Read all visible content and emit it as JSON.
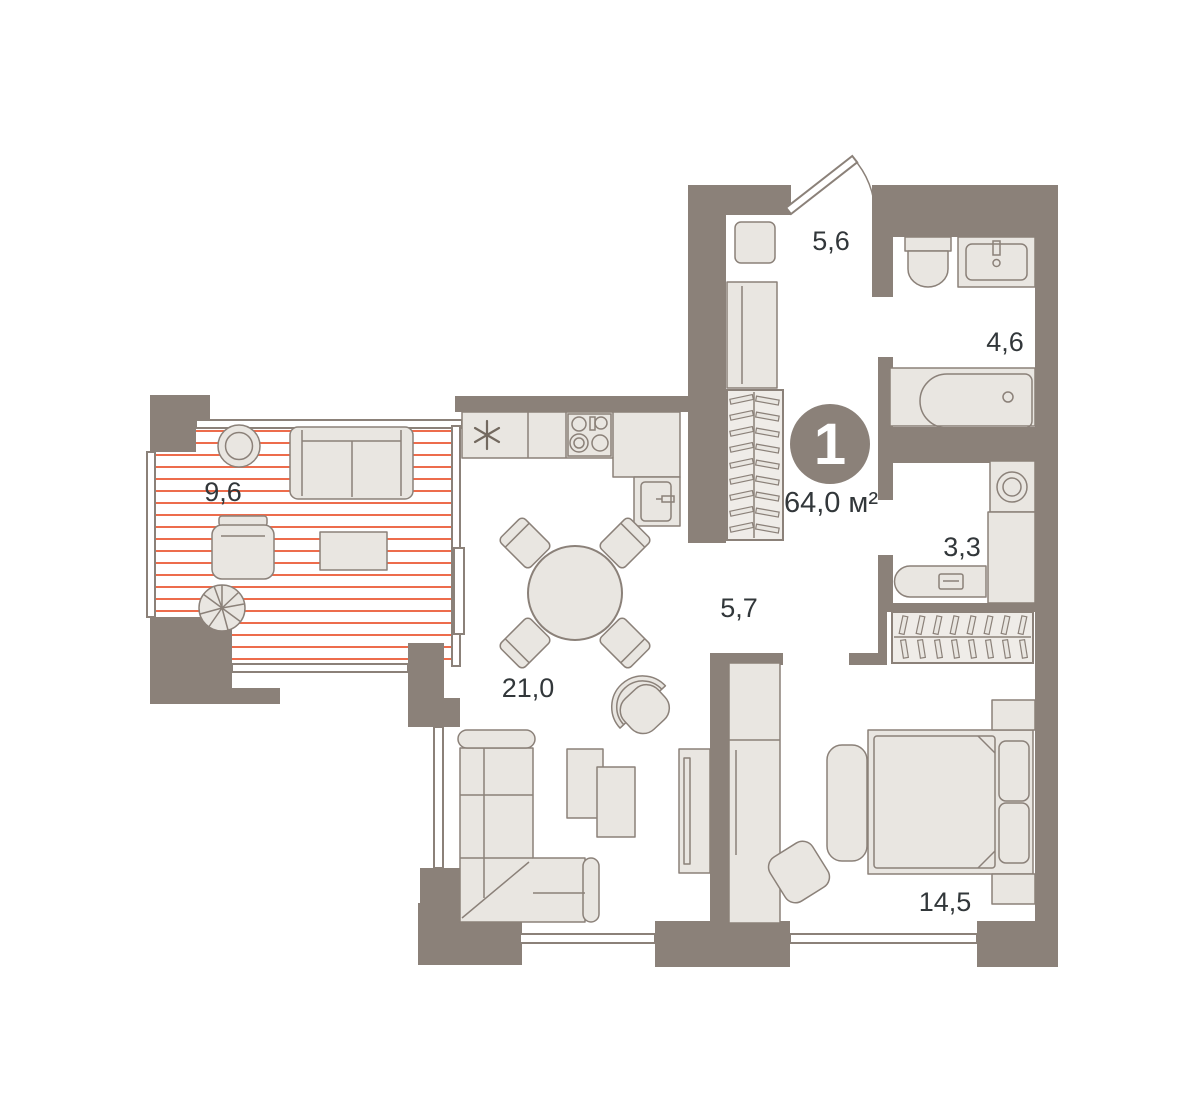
{
  "plan": {
    "badge": {
      "number": "1",
      "area": "64,0 м²"
    },
    "rooms": [
      {
        "id": "hallway",
        "area": "5,6"
      },
      {
        "id": "bathroom",
        "area": "4,6"
      },
      {
        "id": "laundry",
        "area": "3,3"
      },
      {
        "id": "corridor",
        "area": "5,7"
      },
      {
        "id": "kitchen-living",
        "area": "21,0"
      },
      {
        "id": "balcony",
        "area": "9,6"
      },
      {
        "id": "bedroom",
        "area": "14,5"
      }
    ],
    "icons": {
      "fridge": "snowflake-asterisk",
      "washing_machine": "drum-circles",
      "stove": "four-burners",
      "balcony_floor": "red-plank-hatch",
      "wardrobes": "hanger-hatch"
    },
    "colors": {
      "wall": "#8B8179",
      "furniture": "#E9E6E1",
      "line": "#8B8179",
      "hatch": "#ED6C4C",
      "text": "#32373A",
      "badge": "#8B8179",
      "badge_text": "#FFFFFF",
      "bg": "#FFFFFF"
    }
  }
}
